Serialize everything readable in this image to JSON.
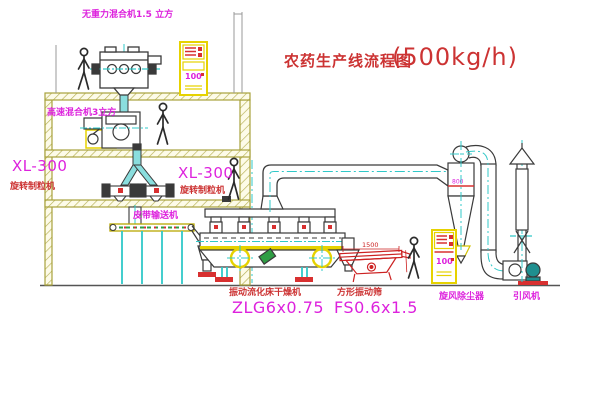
{
  "diagram": {
    "title": "农药生产线流程图",
    "capacity": "(500kg/h)"
  },
  "equipment_labels": {
    "gravity_free_mixer": "无重力混合机1.5 立方",
    "high_speed_mixer": "高速混合机3立方",
    "granulator_left": {
      "model": "XL-300",
      "name": "旋转制粒机"
    },
    "granulator_center": {
      "model": "XL-300",
      "name": "旋转制粒机"
    },
    "belt_conveyor": "皮带输送机",
    "fluid_bed_dryer": {
      "name": "振动流化床干燥机",
      "model": "ZLG6x0.75"
    },
    "vibrating_screen": {
      "name": "方形振动筛",
      "model": "FS0.6x1.5"
    },
    "cyclone_dust_collector": "旋风除尘器",
    "induced_draft_fan": "引风机"
  },
  "dimensions": {
    "screen_length": "1500",
    "cyclone_width": "800"
  },
  "control_panels": {
    "panel_top_display": "100",
    "panel_ground_display": "100"
  },
  "colors": {
    "label_magenta": "#dd22dd",
    "label_red": "#cc3333",
    "structure_olive": "#a8a23c",
    "machine_line": "#3a3a3a",
    "centerline_cyan": "#30c8c8",
    "accent_yellow": "#e6d200",
    "accent_red": "#d83030",
    "accent_green": "#2f9e44"
  }
}
